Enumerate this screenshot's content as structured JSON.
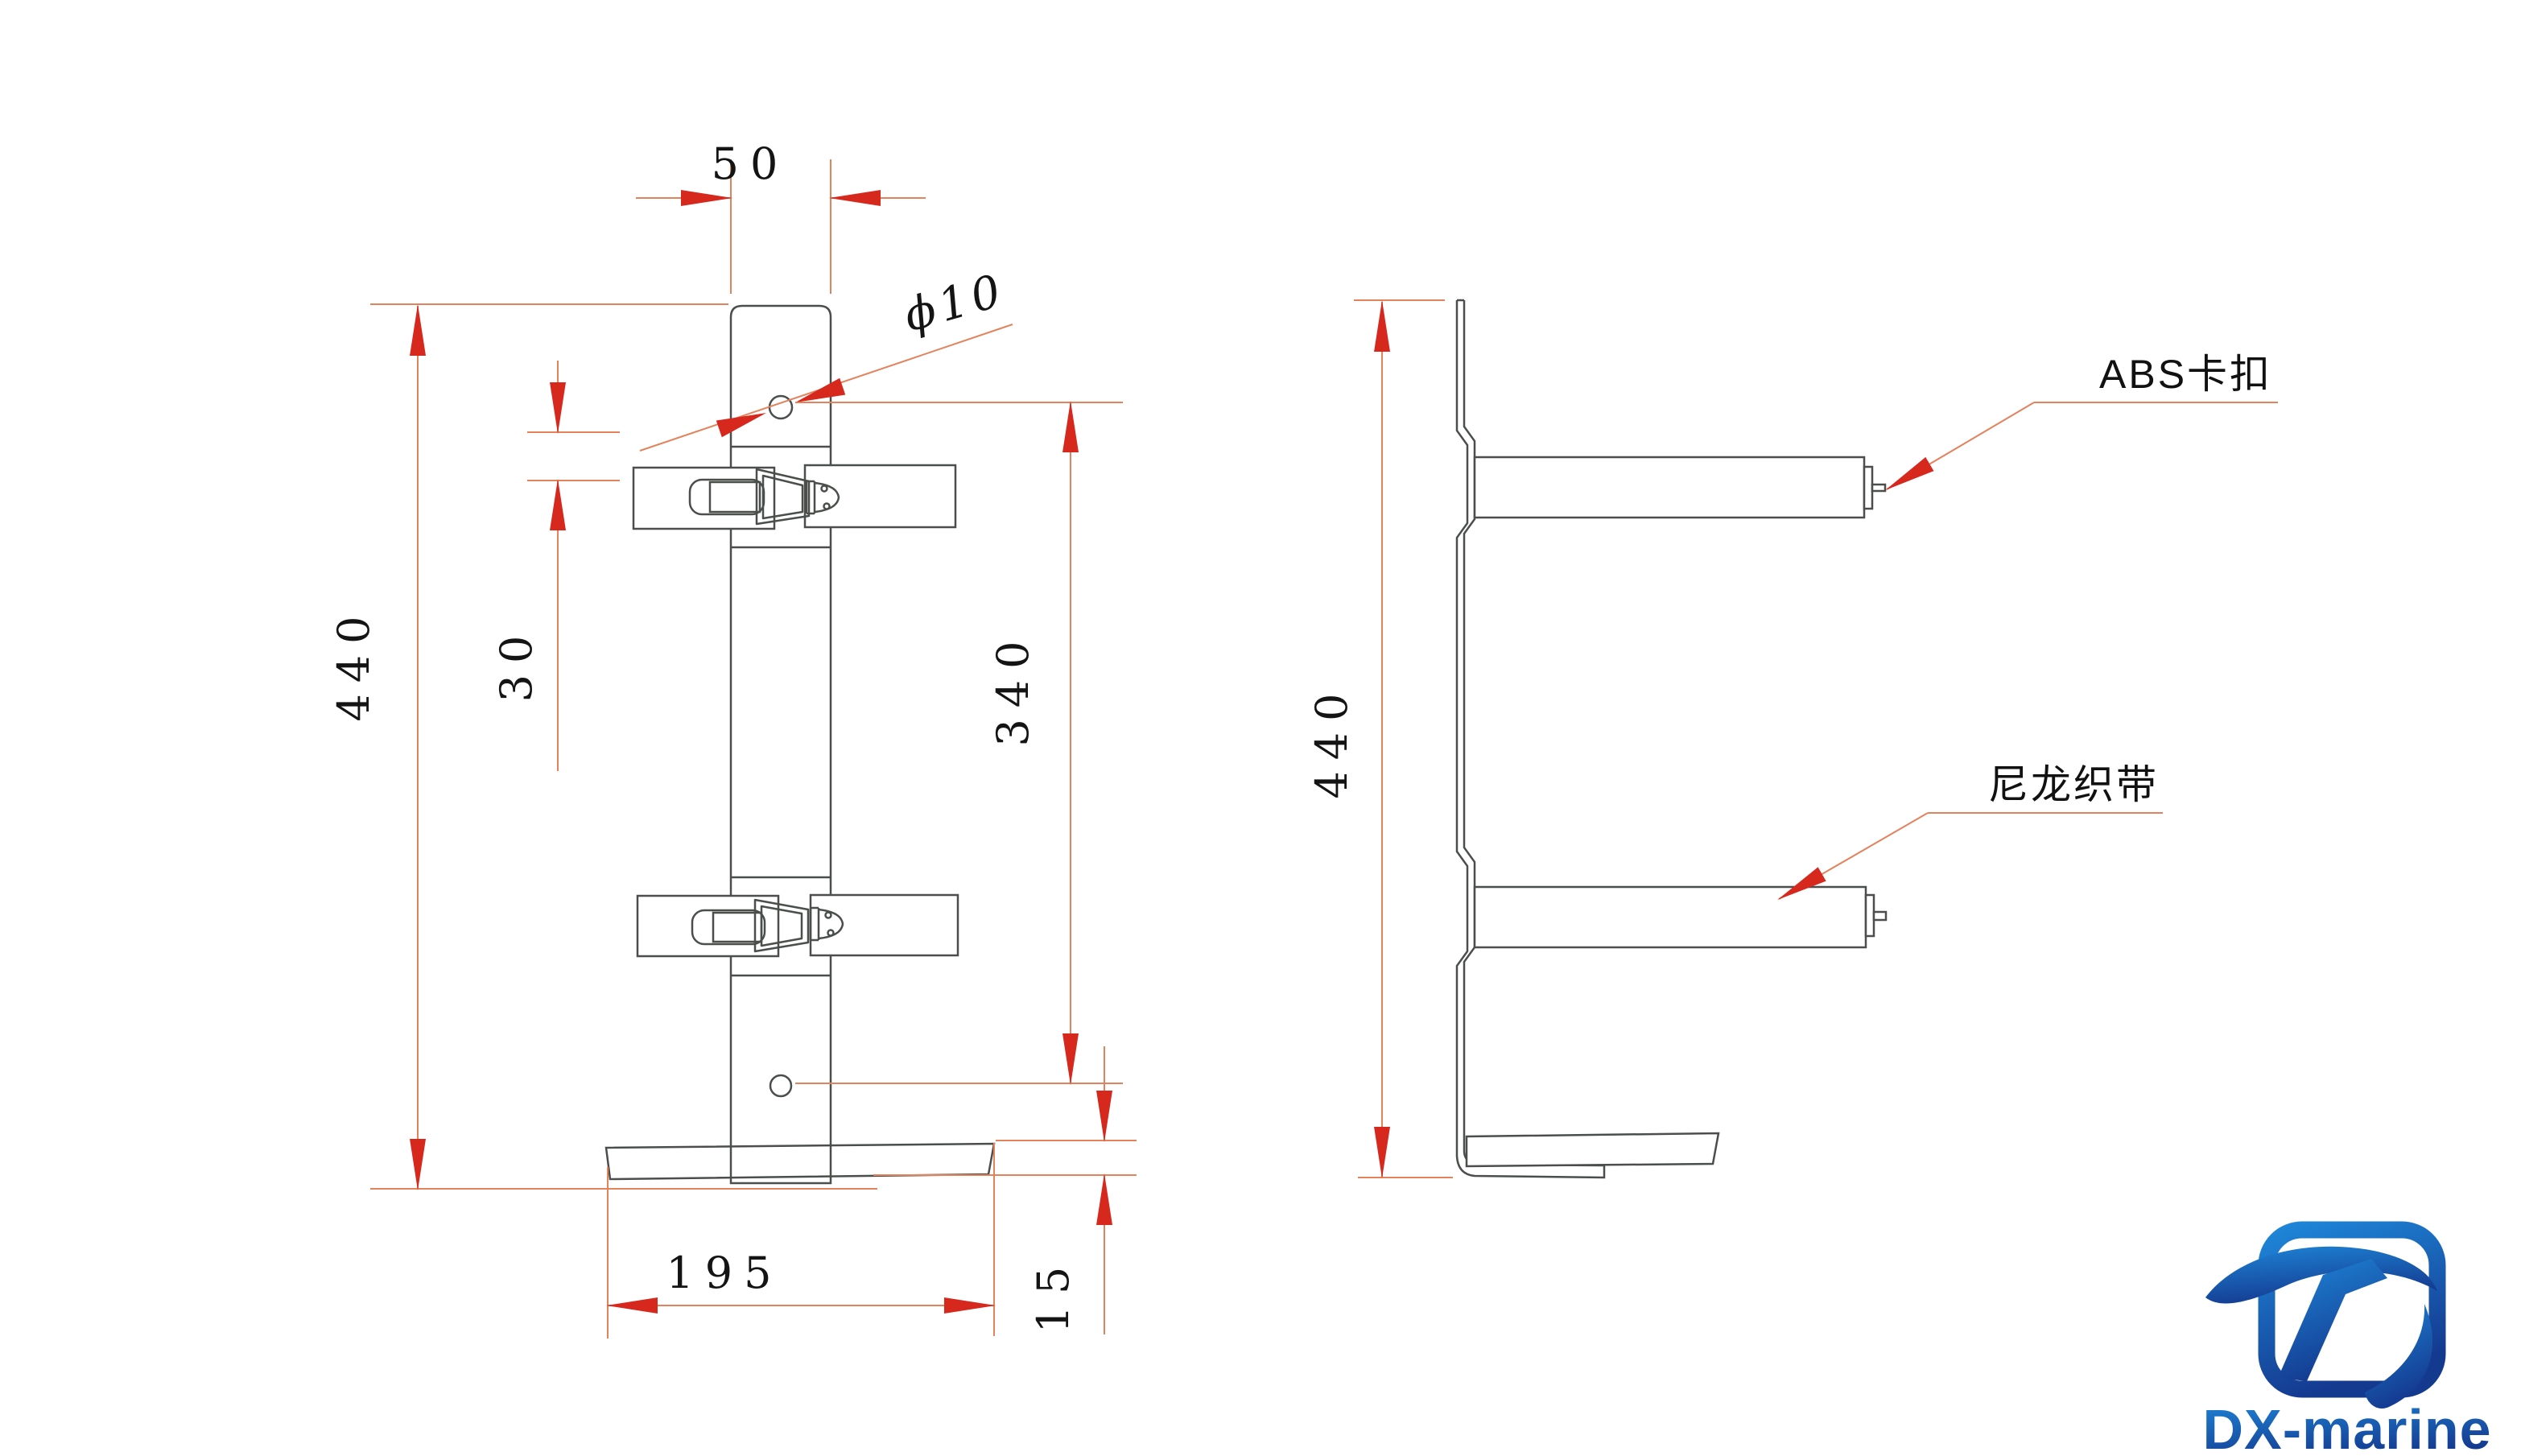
{
  "drawing_title": "fire-extinguisher bracket engineering drawing",
  "colors": {
    "dim_line": "#e4825c",
    "arrow": "#d7281e",
    "geometry_line": "#4a4f4b",
    "text": "#141414",
    "logo_light": "#1e86d8",
    "logo_dark": "#143a90"
  },
  "front_view": {
    "dim_post_width": "50",
    "dim_hole_diameter": "ϕ10",
    "dim_slot_offset": "30",
    "dim_total_height": "440",
    "dim_hole_spacing": "340",
    "dim_base_width": "195",
    "dim_base_lip": "15"
  },
  "side_view": {
    "dim_total_height": "440",
    "label_abs_buckle": "ABS卡扣",
    "label_nylon_webbing": "尼龙织带"
  },
  "logo": {
    "text": "DX-marine"
  }
}
